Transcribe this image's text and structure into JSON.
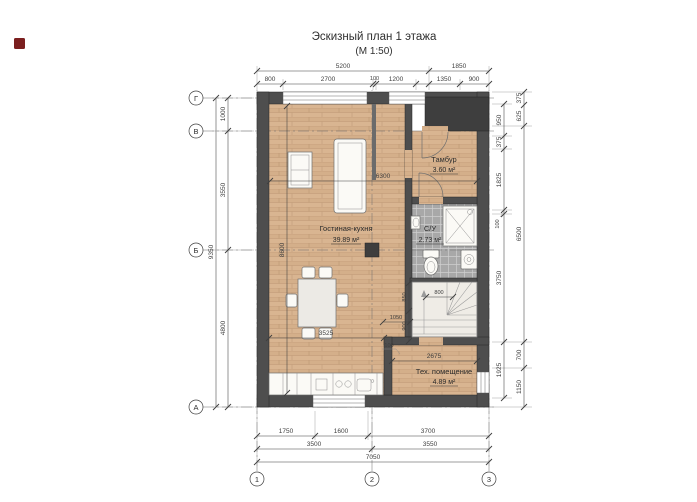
{
  "title": {
    "line1": "Эскизный план 1 этажа",
    "line2": "(М 1:50)"
  },
  "axes": {
    "rows": [
      "Г",
      "В",
      "Б",
      "А"
    ],
    "cols": [
      "1",
      "2",
      "3"
    ]
  },
  "rooms": {
    "tambur": {
      "name": "Тамбур",
      "area": "3.60 м²"
    },
    "living": {
      "name": "Гостиная-кухня",
      "area": "39.89 м²"
    },
    "wc": {
      "name": "С/У",
      "area": "2.73 м²"
    },
    "tech": {
      "name": "Тех. помещение",
      "area": "4.89 м²"
    }
  },
  "dims": {
    "top1_5200": "5200",
    "top1_1850": "1850",
    "top2_800": "800",
    "top2_2700": "2700",
    "top2_100": "100",
    "top2_1200": "1200",
    "top2_1350": "1350",
    "top2_900": "900",
    "left_1000": "1000",
    "left_3550": "3550",
    "left_4800": "4800",
    "left_9350": "9350",
    "ri_950": "950",
    "ri_375": "375",
    "ri_1825": "1825",
    "ri_100": "100",
    "ri_3750": "3750",
    "ri_1925": "1925",
    "ro_375": "375",
    "ro_625": "625",
    "ro_6500": "6500",
    "ro_700": "700",
    "ro_1150": "1150",
    "bot1_1750": "1750",
    "bot1_1600": "1600",
    "bot1_3700": "3700",
    "bot2_3500": "3500",
    "bot2_3550": "3550",
    "bot3_7050": "7050",
    "in_6300": "6300",
    "in_8600": "8600",
    "in_3525": "3525",
    "in_100": "100",
    "in_2675": "2675",
    "st_850": "850",
    "st_800": "800",
    "st_900": "900",
    "st_1050": "1050"
  },
  "colors": {
    "paper": "#ffffff",
    "ink": "#3f3f3f",
    "wall": "#4e4e4e",
    "wall_dark": "#3e3e3e",
    "wood": "#d9b591",
    "tile": "#a8a8a8",
    "stair": "#efece6",
    "furn": "#fbfaf6",
    "marker": "#7b1f1f"
  }
}
